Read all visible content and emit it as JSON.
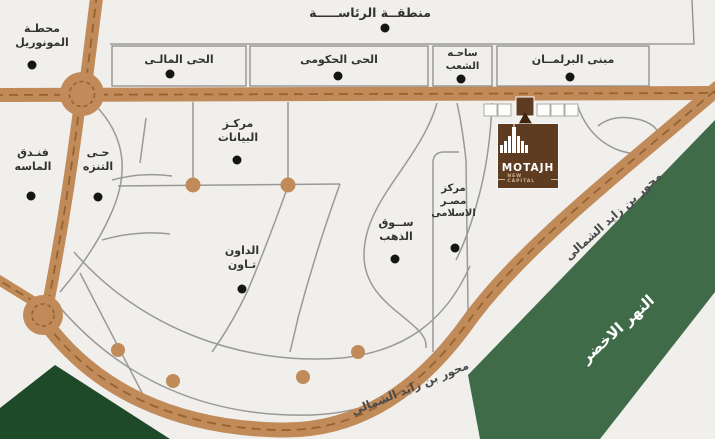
{
  "map": {
    "colors": {
      "background": "#F1EFEC",
      "road": "#C18A59",
      "road_dash": "#96632F",
      "secondary_road": "#999999",
      "district_line": "#8C8C8C",
      "green_river": "#3F6B49",
      "green_corner": "#1E4A29",
      "logo_brown": "#5E3C22",
      "label_text": "#333333"
    },
    "logo": {
      "name": "MOTAJH",
      "subtitle": "NEW CAPITAL"
    },
    "places": {
      "monorail_station": {
        "line1": "محطـة",
        "line2": "المونوريل"
      },
      "presidential_area": {
        "label": "منطقــة الرئاســـــة"
      },
      "financial_district": {
        "label": "الحى المالـى"
      },
      "government_district": {
        "label": "الحى الحكومى"
      },
      "peoples_square": {
        "line1": "ساحـه",
        "line2": "الشعب"
      },
      "parliament_building": {
        "label": "مبنى البرلمــان"
      },
      "almasa_hotel": {
        "line1": "فنـدق",
        "line2": "الماسه"
      },
      "promenade_district": {
        "line1": "حـى",
        "line2": "التنزه"
      },
      "data_center": {
        "line1": "مركـز",
        "line2": "البيانات"
      },
      "downtown": {
        "line1": "الداون",
        "line2": "تـاون"
      },
      "gold_market": {
        "line1": "ســوق",
        "line2": "الذهب"
      },
      "egypt_islamic_center": {
        "line1": "مركز",
        "line2": "مصـر",
        "line3": "الاسلامى"
      }
    },
    "road_labels": {
      "bottom_axis": "محور بن زايد الشمالى",
      "right_axis": "محور بن زايد الشمالى"
    },
    "green_river": {
      "label": "النهر الاخضر"
    }
  }
}
